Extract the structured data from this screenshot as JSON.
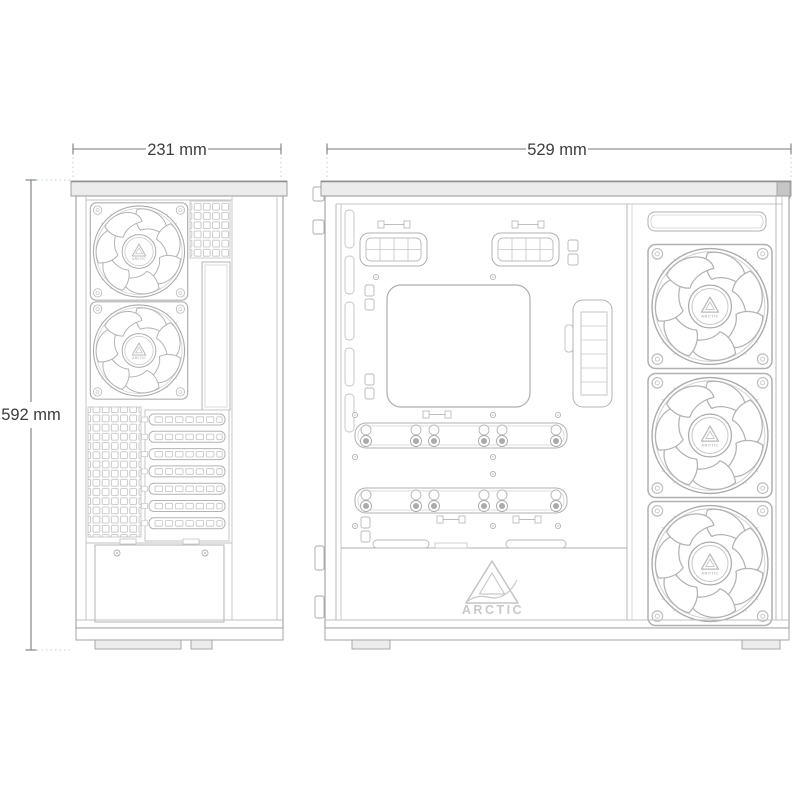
{
  "brand": "ARCTIC",
  "dimensions": {
    "rear_width": "231 mm",
    "side_width": "529 mm",
    "height": "592 mm"
  },
  "views": {
    "rear": {
      "name": "rear-view",
      "fan_count": 2,
      "expansion_slots": 7
    },
    "side": {
      "name": "side-interior-view",
      "fan_count": 3,
      "cable_grommets": 2,
      "drive_rails": 2
    }
  },
  "logo": {
    "brand_text": "ARCTIC"
  },
  "colors": {
    "background": "#ffffff",
    "case_outline": "#a6a6a6",
    "detail_line": "#b8b8b8",
    "light_line": "#cccccc",
    "dim_line": "#7a7a7a",
    "dim_text": "#3d3d3d",
    "extension_dotted": "#b8d2d6",
    "logo_gray": "#c9c9c9",
    "cap_fill": "#ececec"
  }
}
